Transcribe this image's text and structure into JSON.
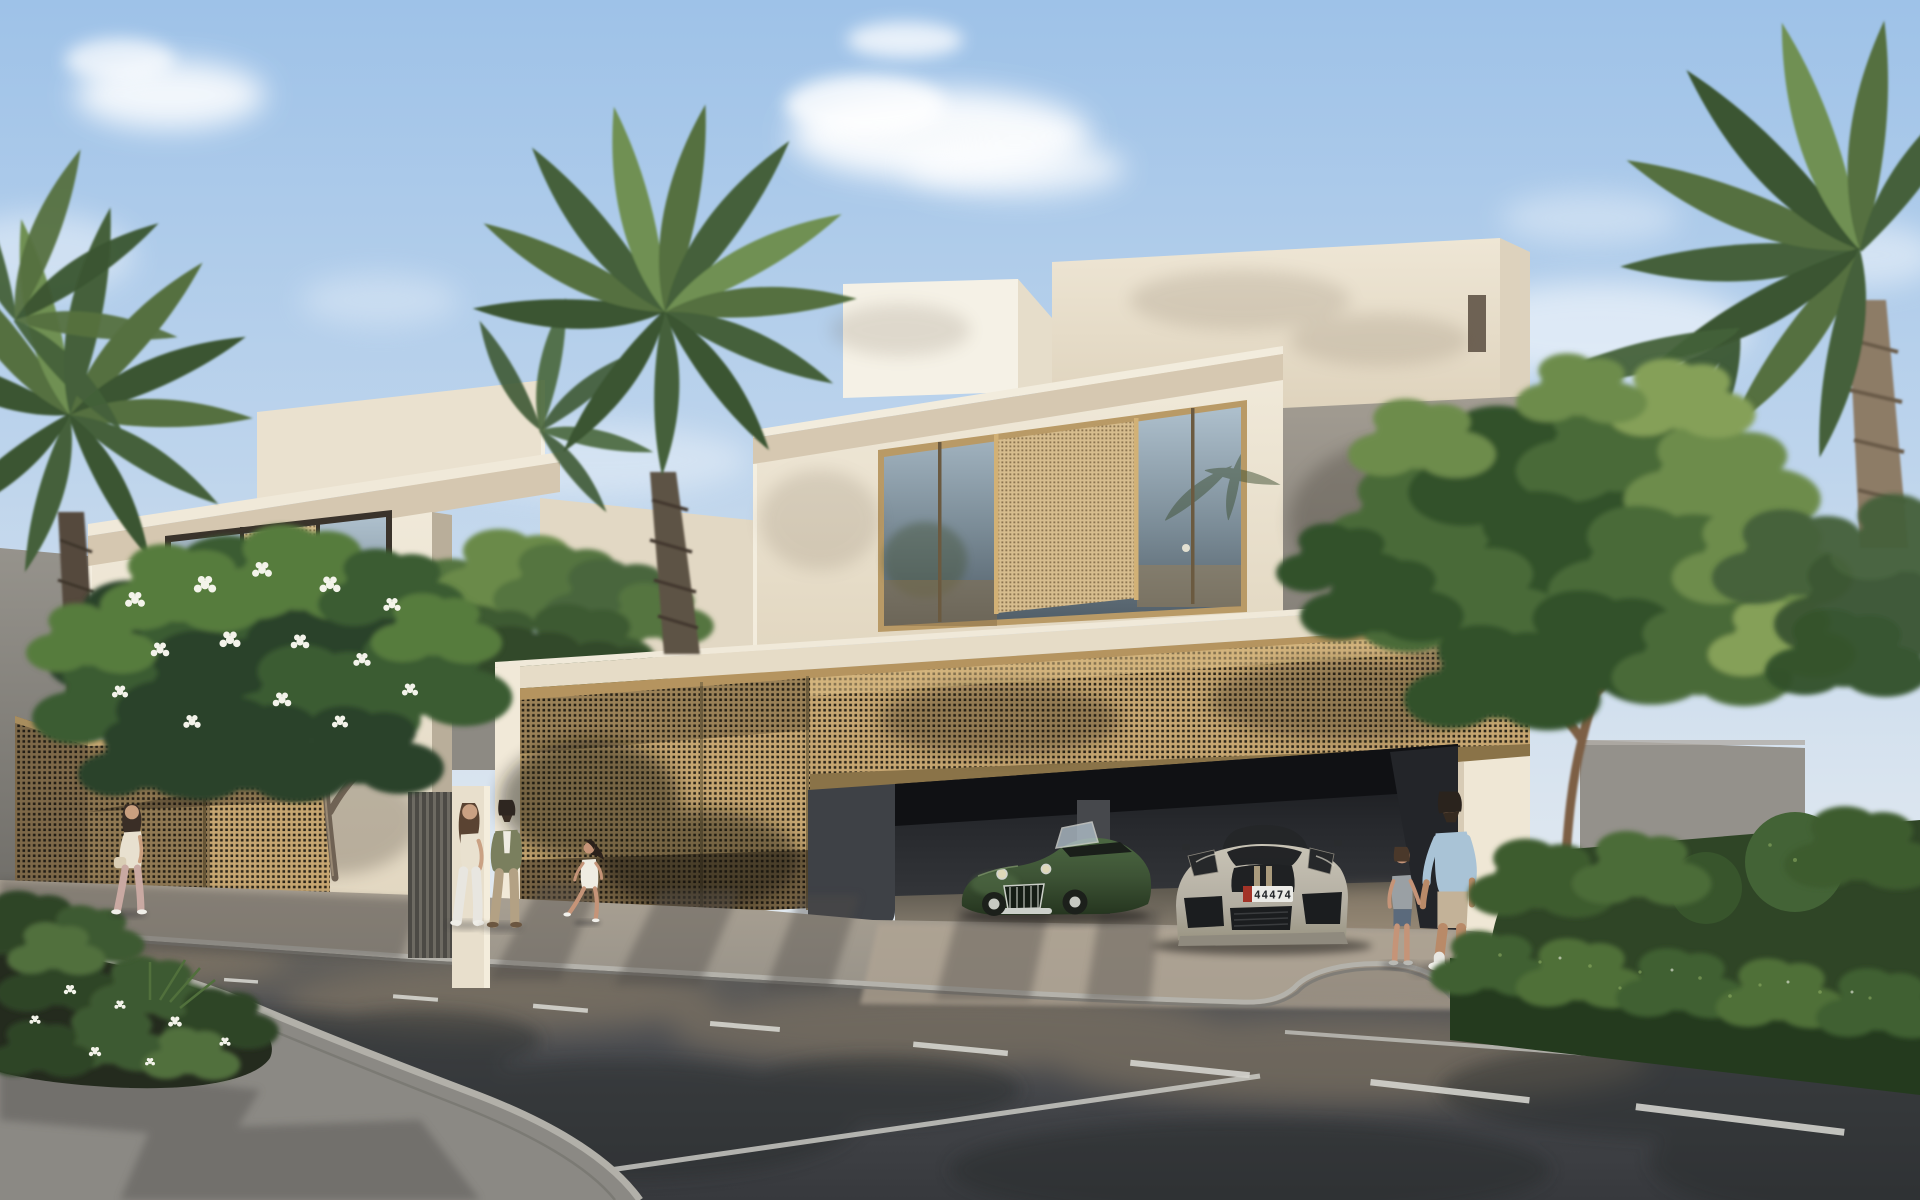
{
  "scene": {
    "title": "Residential villa exterior rendering",
    "setting": "sunny daytime street view of modern cream villas",
    "style": "photorealistic architectural visualization"
  },
  "palette": {
    "sky_top": "#9ec2e8",
    "sky_horizon": "#e4eaf1",
    "wall_cream": "#efe8d8",
    "wall_cream_bright": "#f6f2e8",
    "parapet_band": "#d6c8b1",
    "mesh_gold": "#c6a671",
    "mesh_hole": "#2c2619",
    "window_glass": "#6e7f8a",
    "garage_interior": "#1b1d20",
    "road_asphalt": "#4a4d51",
    "sidewalk": "#a39a8c",
    "curb": "#b4b2ab",
    "lane_marking": "#dcdcd6",
    "foliage_dark": "#2e4527",
    "foliage_light": "#6d8c4c",
    "palm_green": "#55703f",
    "trunk_brown": "#8d7c66",
    "boundary_wall_grey": "#94918b"
  },
  "buildings": {
    "left_villa": {
      "label": "left villa",
      "storeys": 2,
      "window": {
        "panes": 2,
        "screen_panel": "bronze perforated mesh slider"
      },
      "gate": "gold perforated mesh gate"
    },
    "main_villa": {
      "label": "main villa",
      "storeys": 3,
      "window": {
        "panes": 3,
        "screen_panel": "bronze perforated mesh slider"
      },
      "garage": {
        "state": "open",
        "screen": "raised perforated bronze screen",
        "cars_inside": 2
      }
    },
    "background": "grey boundary walls and neighbouring villa"
  },
  "vehicles": [
    {
      "label": "classic green roadster",
      "body_color": "#3d5335",
      "details": "chrome grille, round headlights, wire wheels, open top"
    },
    {
      "label": "grey sports car",
      "body_color": "#b3aea2",
      "roof": "black targa",
      "plate": {
        "text": "44474",
        "badge_color": "#a33327",
        "plate_color": "#ebebe7"
      }
    }
  ],
  "people": [
    {
      "label": "woman walking with bag",
      "top": "#e8e0cf",
      "bottom": "#c9a9a2",
      "position": "far left sidewalk"
    },
    {
      "label": "woman of couple",
      "top": "#e9e1cf",
      "bottom": "#e8e6e0",
      "position": "left walkway"
    },
    {
      "label": "man of couple",
      "top": "#7a7f5e",
      "bottom": "#b3a184",
      "position": "left walkway"
    },
    {
      "label": "girl running",
      "top": "#efece2",
      "bottom": "#efece2",
      "position": "center walkway"
    },
    {
      "label": "boy",
      "top": "#9aa0a4",
      "bottom": "#5b6a7c",
      "position": "right driveway"
    },
    {
      "label": "man holding boy's hand",
      "top": "#a9c3d6",
      "bottom": "#c3b298",
      "position": "right driveway"
    }
  ],
  "vegetation": {
    "palms": 4,
    "flowering_tree": "frangipani with white blossoms",
    "street_tree": "large green canopy tree",
    "hedges": "trimmed hedges with topiary balls",
    "planter": "corner bed with shrubs and white flowers"
  },
  "road": {
    "lane_dashes": 8,
    "edge_line": true,
    "surface": "asphalt with warm light and tree shadows"
  }
}
